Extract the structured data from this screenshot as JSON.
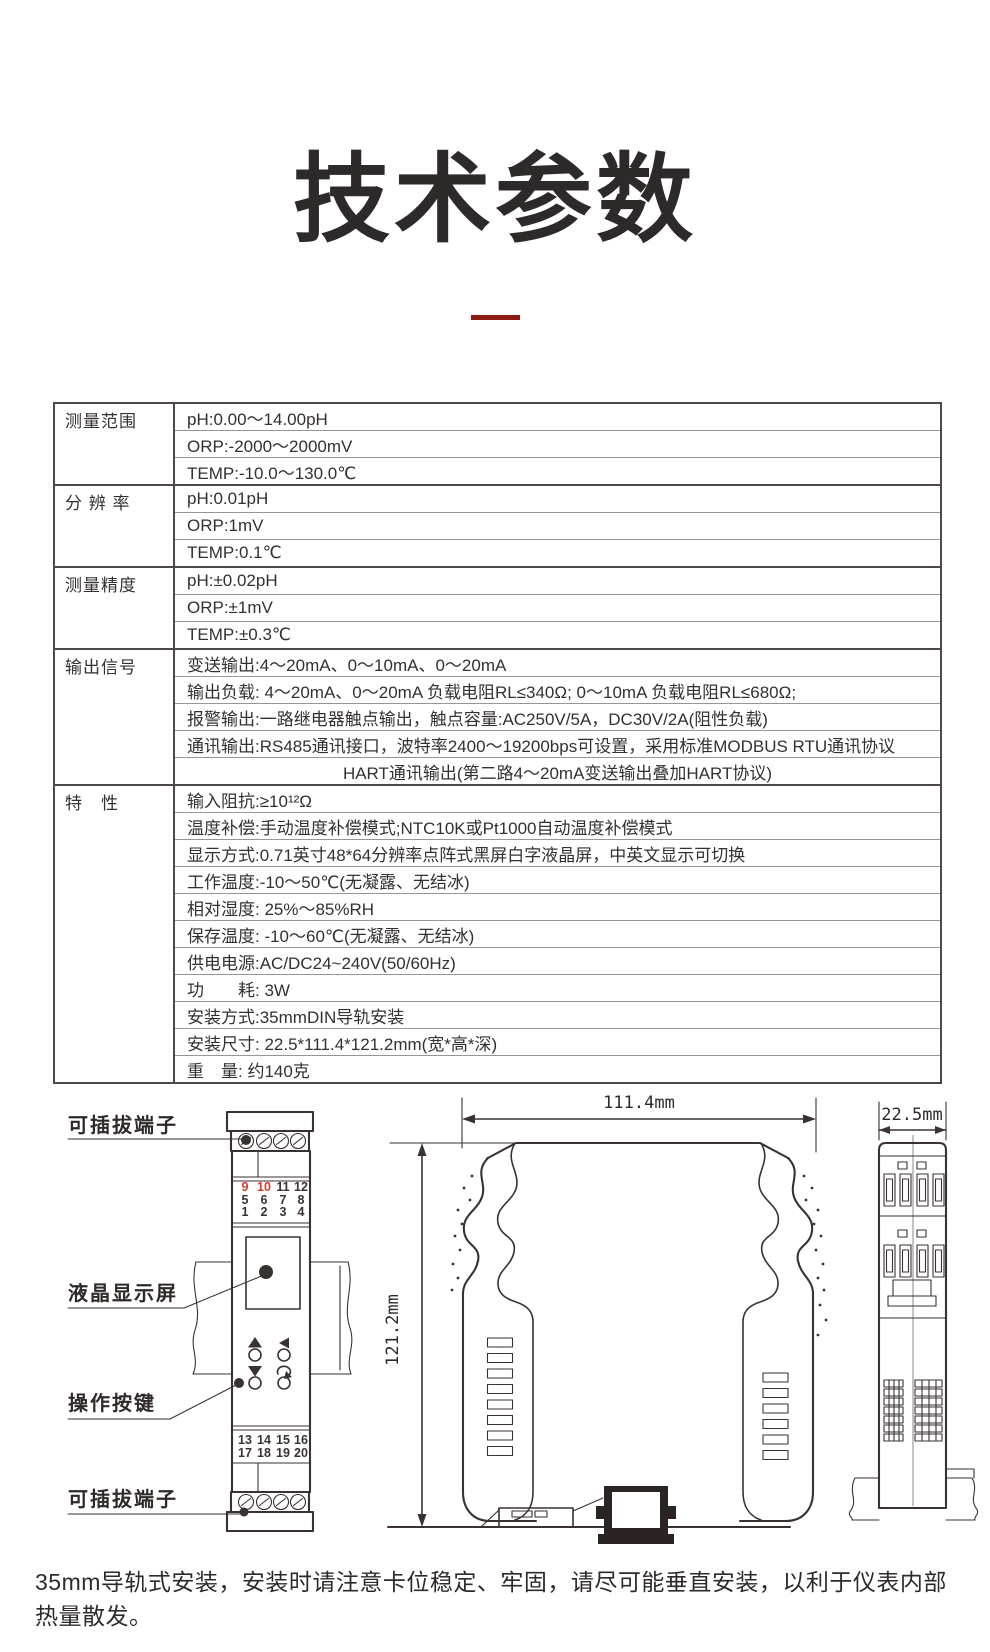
{
  "title": "技术参数",
  "accent": {
    "divider_color": "#8a1a12",
    "terminal_red": "#d23d28"
  },
  "table": {
    "groups": [
      {
        "label": "测量范围",
        "rows": [
          "pH:0.00～14.00pH",
          "ORP:-2000～2000mV",
          "TEMP:-10.0～130.0℃"
        ]
      },
      {
        "label": "分 辨 率",
        "rows": [
          "pH:0.01pH",
          "ORP:1mV",
          "TEMP:0.1℃"
        ]
      },
      {
        "label": "测量精度",
        "rows": [
          "pH:±0.02pH",
          "ORP:±1mV",
          "TEMP:±0.3℃"
        ]
      },
      {
        "label": "输出信号",
        "rows": [
          "变送输出:4～20mA、0～10mA、0～20mA",
          "输出负载: 4～20mA、0～20mA 负载电阻RL≤340Ω; 0～10mA 负载电阻RL≤680Ω;",
          "报警输出:一路继电器触点输出，触点容量:AC250V/5A，DC30V/2A(阻性负载)",
          "通讯输出:RS485通讯接口，波特率2400～19200bps可设置，采用标准MODBUS RTU通讯协议",
          "HART通讯输出(第二路4～20mA变送输出叠加HART协议)"
        ]
      },
      {
        "label": "特　性",
        "rows": [
          "输入阻抗:≥10¹²Ω",
          "温度补偿:手动温度补偿模式;NTC10K或Pt1000自动温度补偿模式",
          "显示方式:0.71英寸48*64分辨率点阵式黑屏白字液晶屏，中英文显示可切换",
          "工作温度:-10～50℃(无凝露、无结冰)",
          "相对湿度: 25%～85%RH",
          "保存温度: -10～60℃(无凝露、无结冰)",
          "供电电源:AC/DC24~240V(50/60Hz)",
          "功　　耗: 3W",
          "安装方式:35mmDIN导轨安装",
          "安装尺寸: 22.5*111.4*121.2mm(宽*高*深)",
          "重　量: 约140克"
        ]
      }
    ]
  },
  "diagram": {
    "labels": {
      "top_terminal": "可插拔端子",
      "lcd": "液晶显示屏",
      "buttons": "操作按键",
      "bottom_terminal": "可插拔端子"
    },
    "dimensions": {
      "width": "111.4mm",
      "height": "121.2mm",
      "depth": "22.5mm"
    },
    "terminals": {
      "t1": [
        "9",
        "10",
        "11",
        "12"
      ],
      "t2": [
        "5",
        "6",
        "7",
        "8"
      ],
      "t3": [
        "1",
        "2",
        "3",
        "4"
      ],
      "b1": [
        "13",
        "14",
        "15",
        "16"
      ],
      "b2": [
        "17",
        "18",
        "19",
        "20"
      ]
    }
  },
  "footer": {
    "note": "35mm导轨式安装，安装时请注意卡位稳定、牢固，请尽可能垂直安装，以利于仪表内部热量散发。"
  }
}
